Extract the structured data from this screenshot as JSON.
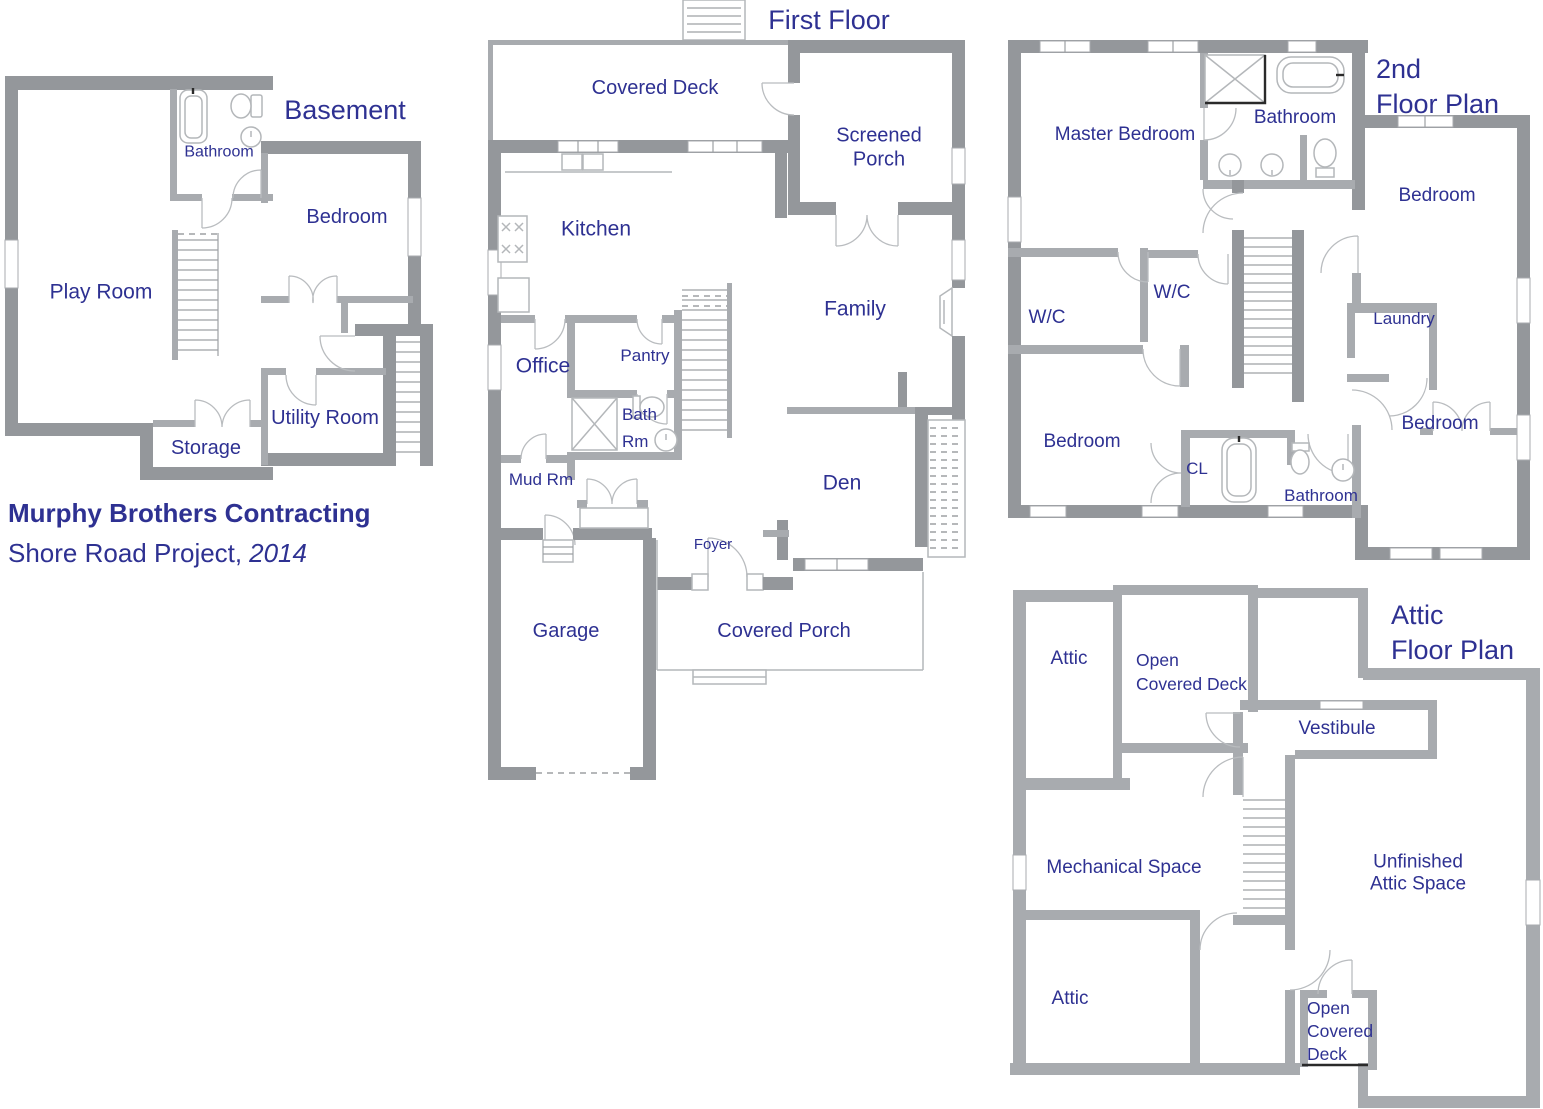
{
  "title_block": {
    "company": "Murphy Brothers Contracting",
    "project": "Shore Road Project,",
    "year": "2014"
  },
  "plans": {
    "basement": {
      "title": "Basement",
      "rooms": {
        "bathroom": "Bathroom",
        "bedroom": "Bedroom",
        "play_room": "Play Room",
        "utility_room": "Utility Room",
        "storage": "Storage"
      }
    },
    "first_floor": {
      "title": "First Floor",
      "rooms": {
        "covered_deck": "Covered Deck",
        "screened_porch": "Screened\nPorch",
        "kitchen": "Kitchen",
        "family": "Family",
        "office": "Office",
        "pantry": "Pantry",
        "bath_rm": "Bath\nRm",
        "mud_rm": "Mud Rm",
        "den": "Den",
        "foyer": "Foyer",
        "garage": "Garage",
        "covered_porch": "Covered Porch"
      }
    },
    "second_floor": {
      "title": "2nd\nFloor Plan",
      "rooms": {
        "master_bedroom": "Master Bedroom",
        "bathroom_top": "Bathroom",
        "bedroom_top_right": "Bedroom",
        "wc_left": "W/C",
        "wc_center": "W/C",
        "laundry": "Laundry",
        "bedroom_bottom_left": "Bedroom",
        "closet": "CL",
        "bathroom_bottom": "Bathroom",
        "bedroom_bottom_right": "Bedroom"
      }
    },
    "attic": {
      "title": "Attic\nFloor Plan",
      "rooms": {
        "attic_top": "Attic",
        "open_covered_deck_top": "Open\nCovered Deck",
        "vestibule": "Vestibule",
        "mechanical_space": "Mechanical Space",
        "unfinished": "Unfinished Attic Space",
        "attic_bottom": "Attic",
        "open_covered_deck_bottom": "Open\nCovered\nDeck"
      }
    }
  },
  "colors": {
    "label_navy": "#2e3192",
    "wall_gray": "#94979b",
    "wall_light_gray": "#a8abaf"
  }
}
